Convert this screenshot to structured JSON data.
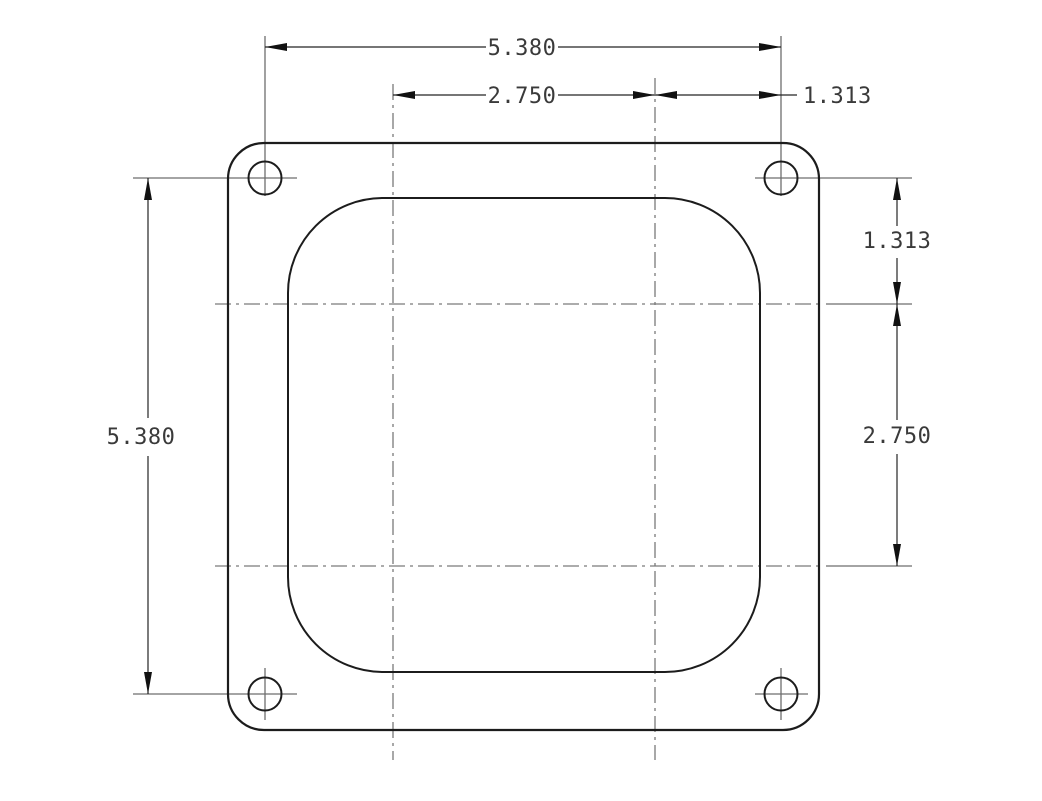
{
  "drawing": {
    "type": "technical-drawing",
    "background_color": "#ffffff",
    "object_line_color": "#1c1c1c",
    "centerline_color": "#7a7a7a",
    "text_color": "#3a3a3a",
    "dimensions": {
      "horizontal": {
        "bolt_span": "5.380",
        "bore_span": "2.750",
        "bore_to_bolt": "1.313"
      },
      "vertical": {
        "bolt_to_bore": "1.313",
        "bore_span": "2.750",
        "bolt_span": "5.380"
      }
    }
  }
}
